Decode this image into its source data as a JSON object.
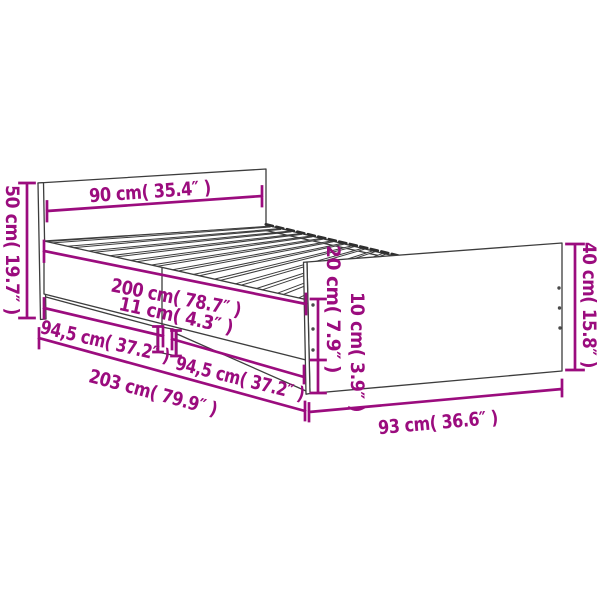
{
  "diagram": {
    "subject": "bed-frame-dimension-diagram",
    "accent_color": "#9B0C7E",
    "outline_color": "#3D3D3D",
    "background": "#FFFFFF",
    "dimensions": {
      "headboard_height": {
        "label": "50 cm( 19.7″ )"
      },
      "headboard_width": {
        "label": "90 cm( 35.4″ )"
      },
      "inner_length": {
        "label": "200 cm( 78.7″ )"
      },
      "rail_board_height": {
        "label": "11 cm( 4.3″ )"
      },
      "slat_section_left": {
        "label": "94,5 cm( 37.2″ )"
      },
      "slat_section_right": {
        "label": "94,5 cm( 37.2″ )"
      },
      "total_length": {
        "label": "203 cm( 79.9″ )"
      },
      "side_height": {
        "label": "20 cm( 7.9″ )"
      },
      "floor_clearance": {
        "label": "10 cm( 3.9″ )"
      },
      "footboard_height": {
        "label": "40 cm( 15.8″ )"
      },
      "footboard_width": {
        "label": "93 cm( 36.6″ )"
      }
    }
  }
}
